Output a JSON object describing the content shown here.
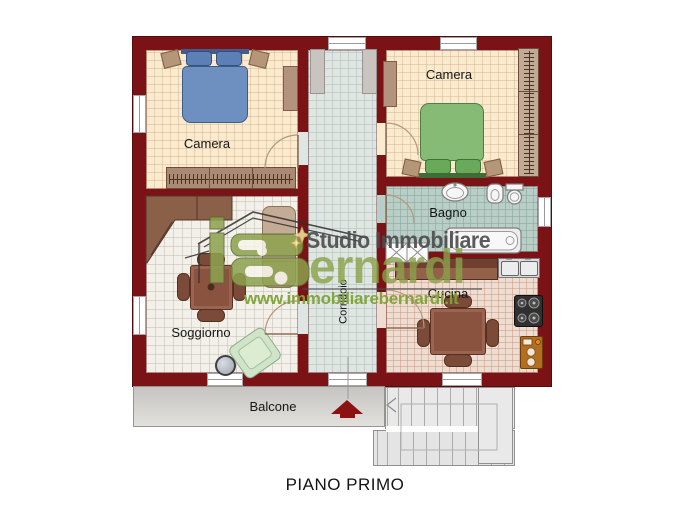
{
  "floorplan": {
    "title": "PIANO PRIMO",
    "rooms": [
      {
        "id": "camera-1",
        "label": "Camera"
      },
      {
        "id": "camera-2",
        "label": "Camera"
      },
      {
        "id": "bagno",
        "label": "Bagno"
      },
      {
        "id": "cucina",
        "label": "Cucina"
      },
      {
        "id": "soggiorno",
        "label": "Soggiorno"
      },
      {
        "id": "corridoio",
        "label": "Corridoio"
      },
      {
        "id": "balcone",
        "label": "Balcone"
      }
    ],
    "colors": {
      "wall": "#7a1216",
      "bedroom_floor": "#f9ead0",
      "living_floor": "#f2f0e9",
      "corridor_floor": "#dee5e2",
      "bath_floor": "#b9cec7",
      "kitchen_floor": "#f0ddd1",
      "balcony_floor": "#d6d4d0",
      "brand_green": "#8ba249",
      "entrance_arrow_red": "#8c1212"
    }
  },
  "watermark": {
    "agency_line": "Studio Immobiliare",
    "brand": "Bernardi",
    "brand_suffix": "ernardi",
    "website": "www.immobiliarebernardi.it"
  }
}
